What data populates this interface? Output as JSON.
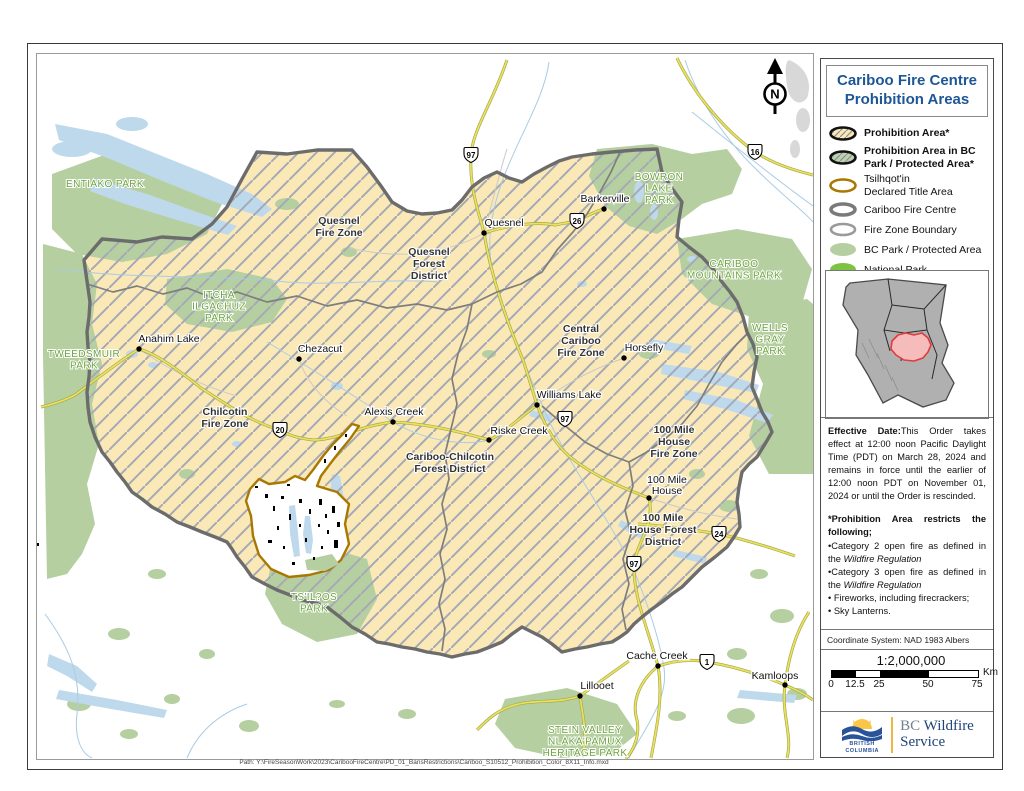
{
  "page": {
    "path_text": "Path: Y:\\FireSeasonWork\\2023\\CaribooFireCentre\\PD_01_BansRestrictions\\Cariboo_S10512_Prohibition_Color_8X11_Info.mxd"
  },
  "colors": {
    "title_blue": "#1d5795",
    "prohibition_yellow": "#fae9b6",
    "prohibition_park_green": "#bbd4ae",
    "bc_park_green": "#b5cfa0",
    "national_park_green": "#7dc242",
    "tsilhqotin_brown": "#a87800",
    "fire_centre_gray": "#6c6c6c",
    "water_blue": "#bfd9ec",
    "inset_highlight_fill": "#f6bcbc",
    "inset_highlight_stroke": "#e23b3b"
  },
  "sidebar": {
    "title": {
      "line1": "Cariboo Fire Centre",
      "line2": "Prohibition Areas"
    },
    "legend": {
      "items": [
        {
          "label": "Prohibition Area*"
        },
        {
          "label": "Prohibition Area in BC\nPark / Protected Area*"
        },
        {
          "label": "Tsilhqot'in\nDeclared Title Area"
        },
        {
          "label": "Cariboo Fire Centre"
        },
        {
          "label": "Fire Zone Boundary"
        },
        {
          "label": "BC Park / Protected Area"
        },
        {
          "label": "National Park"
        }
      ]
    },
    "effective": {
      "bold": "Effective Date:",
      "text": "This Order takes effect at 12:00 noon Pacific Daylight Time (PDT) on March 28, 2024 and remains in force until the earlier of 12:00 noon PDT on November 01, 2024 or until the Order is rescinded.",
      "heading": "*Prohibition Area  restricts the following;",
      "items": [
        {
          "pre": "•Category 2 open fire as defined in the ",
          "italic": "Wildfire Regulation"
        },
        {
          "pre": "•Category 3 open fire as defined in the ",
          "italic": "Wildfire Regulation"
        },
        {
          "pre": "• Fireworks, including firecrackers;",
          "italic": ""
        },
        {
          "pre": "• Sky Lanterns.",
          "italic": ""
        }
      ]
    },
    "coordinate_system": "Coordinate System: NAD 1983 Albers",
    "scale": {
      "ratio": "1:2,000,000",
      "unit": "Km",
      "ticks": [
        {
          "label": "0",
          "pos": 0
        },
        {
          "label": "12.5",
          "pos": 24
        },
        {
          "label": "25",
          "pos": 48
        },
        {
          "label": "50",
          "pos": 97
        },
        {
          "label": "75",
          "pos": 146
        }
      ]
    },
    "logo": {
      "brand_line1": "BRITISH",
      "brand_line2": "COLUMBIA",
      "org_bc": "BC",
      "org_rest": " Wildfire",
      "org_line2": "Service"
    }
  },
  "map": {
    "north": "N",
    "cities": [
      {
        "name": "Quesnel",
        "x": 467,
        "y": 172,
        "dot": [
          447,
          179
        ]
      },
      {
        "name": "Barkerville",
        "x": 568,
        "y": 148,
        "dot": [
          567,
          155
        ]
      },
      {
        "name": "Anahim Lake",
        "x": 132,
        "y": 288,
        "dot": [
          102,
          295
        ]
      },
      {
        "name": "Chezacut",
        "x": 283,
        "y": 298,
        "dot": [
          262,
          305
        ]
      },
      {
        "name": "Alexis Creek",
        "x": 357,
        "y": 361,
        "dot": [
          356,
          368
        ]
      },
      {
        "name": "Riske Creek",
        "x": 482,
        "y": 380,
        "dot": [
          452,
          386
        ]
      },
      {
        "name": "Williams Lake",
        "x": 532,
        "y": 344,
        "dot": [
          500,
          351
        ]
      },
      {
        "name": "Horsefly",
        "x": 607,
        "y": 297,
        "dot": [
          587,
          304
        ]
      },
      {
        "name": "100 Mile\nHouse",
        "x": 630,
        "y": 429,
        "dot": [
          612,
          444
        ]
      },
      {
        "name": "Cache Creek",
        "x": 620,
        "y": 605,
        "dot": [
          621,
          612
        ]
      },
      {
        "name": "Lillooet",
        "x": 560,
        "y": 635,
        "dot": [
          543,
          642
        ]
      },
      {
        "name": "Kamloops",
        "x": 738,
        "y": 625,
        "dot": [
          748,
          631
        ]
      }
    ],
    "zone_labels": [
      {
        "lines": [
          "Quesnel",
          "Fire Zone"
        ],
        "x": 302,
        "y": 170
      },
      {
        "lines": [
          "Quesnel",
          "Forest",
          "District"
        ],
        "x": 392,
        "y": 201
      },
      {
        "lines": [
          "Central",
          "Cariboo",
          "Fire Zone"
        ],
        "x": 544,
        "y": 278
      },
      {
        "lines": [
          "Chilcotin",
          "Fire Zone"
        ],
        "x": 188,
        "y": 361
      },
      {
        "lines": [
          "Cariboo-Chilcotin",
          "Forest District"
        ],
        "x": 413,
        "y": 406
      },
      {
        "lines": [
          "100 Mile",
          "House",
          "Fire Zone"
        ],
        "x": 637,
        "y": 379
      },
      {
        "lines": [
          "100 Mile",
          "House Forest",
          "District"
        ],
        "x": 626,
        "y": 467
      }
    ],
    "park_labels": [
      {
        "lines": [
          "ENTIAKO PARK"
        ],
        "x": 68,
        "y": 133
      },
      {
        "lines": [
          "TWEEDSMUIR",
          "PARK"
        ],
        "x": 47,
        "y": 303
      },
      {
        "lines": [
          "ITCHA",
          "ILGACHUZ",
          "PARK"
        ],
        "x": 182,
        "y": 244
      },
      {
        "lines": [
          "BOWRON",
          "LAKE",
          "PARK"
        ],
        "x": 622,
        "y": 126
      },
      {
        "lines": [
          "CARIBOO",
          "MOUNTAINS PARK"
        ],
        "x": 697,
        "y": 213
      },
      {
        "lines": [
          "WELLS",
          "GRAY",
          "PARK"
        ],
        "x": 733,
        "y": 277
      },
      {
        "lines": [
          "TS'IL?OS",
          "PARK"
        ],
        "x": 277,
        "y": 546
      },
      {
        "lines": [
          "STEIN VALLEY",
          "NLAKA'PAMUX",
          "HERITAGE PARK"
        ],
        "x": 548,
        "y": 679
      }
    ],
    "highway_shields": [
      {
        "num": "97",
        "x": 434,
        "y": 101
      },
      {
        "num": "26",
        "x": 540,
        "y": 167
      },
      {
        "num": "16",
        "x": 718,
        "y": 98
      },
      {
        "num": "20",
        "x": 243,
        "y": 376
      },
      {
        "num": "97",
        "x": 528,
        "y": 365
      },
      {
        "num": "24",
        "x": 682,
        "y": 480
      },
      {
        "num": "97",
        "x": 597,
        "y": 510
      },
      {
        "num": "1",
        "x": 670,
        "y": 608
      }
    ]
  }
}
